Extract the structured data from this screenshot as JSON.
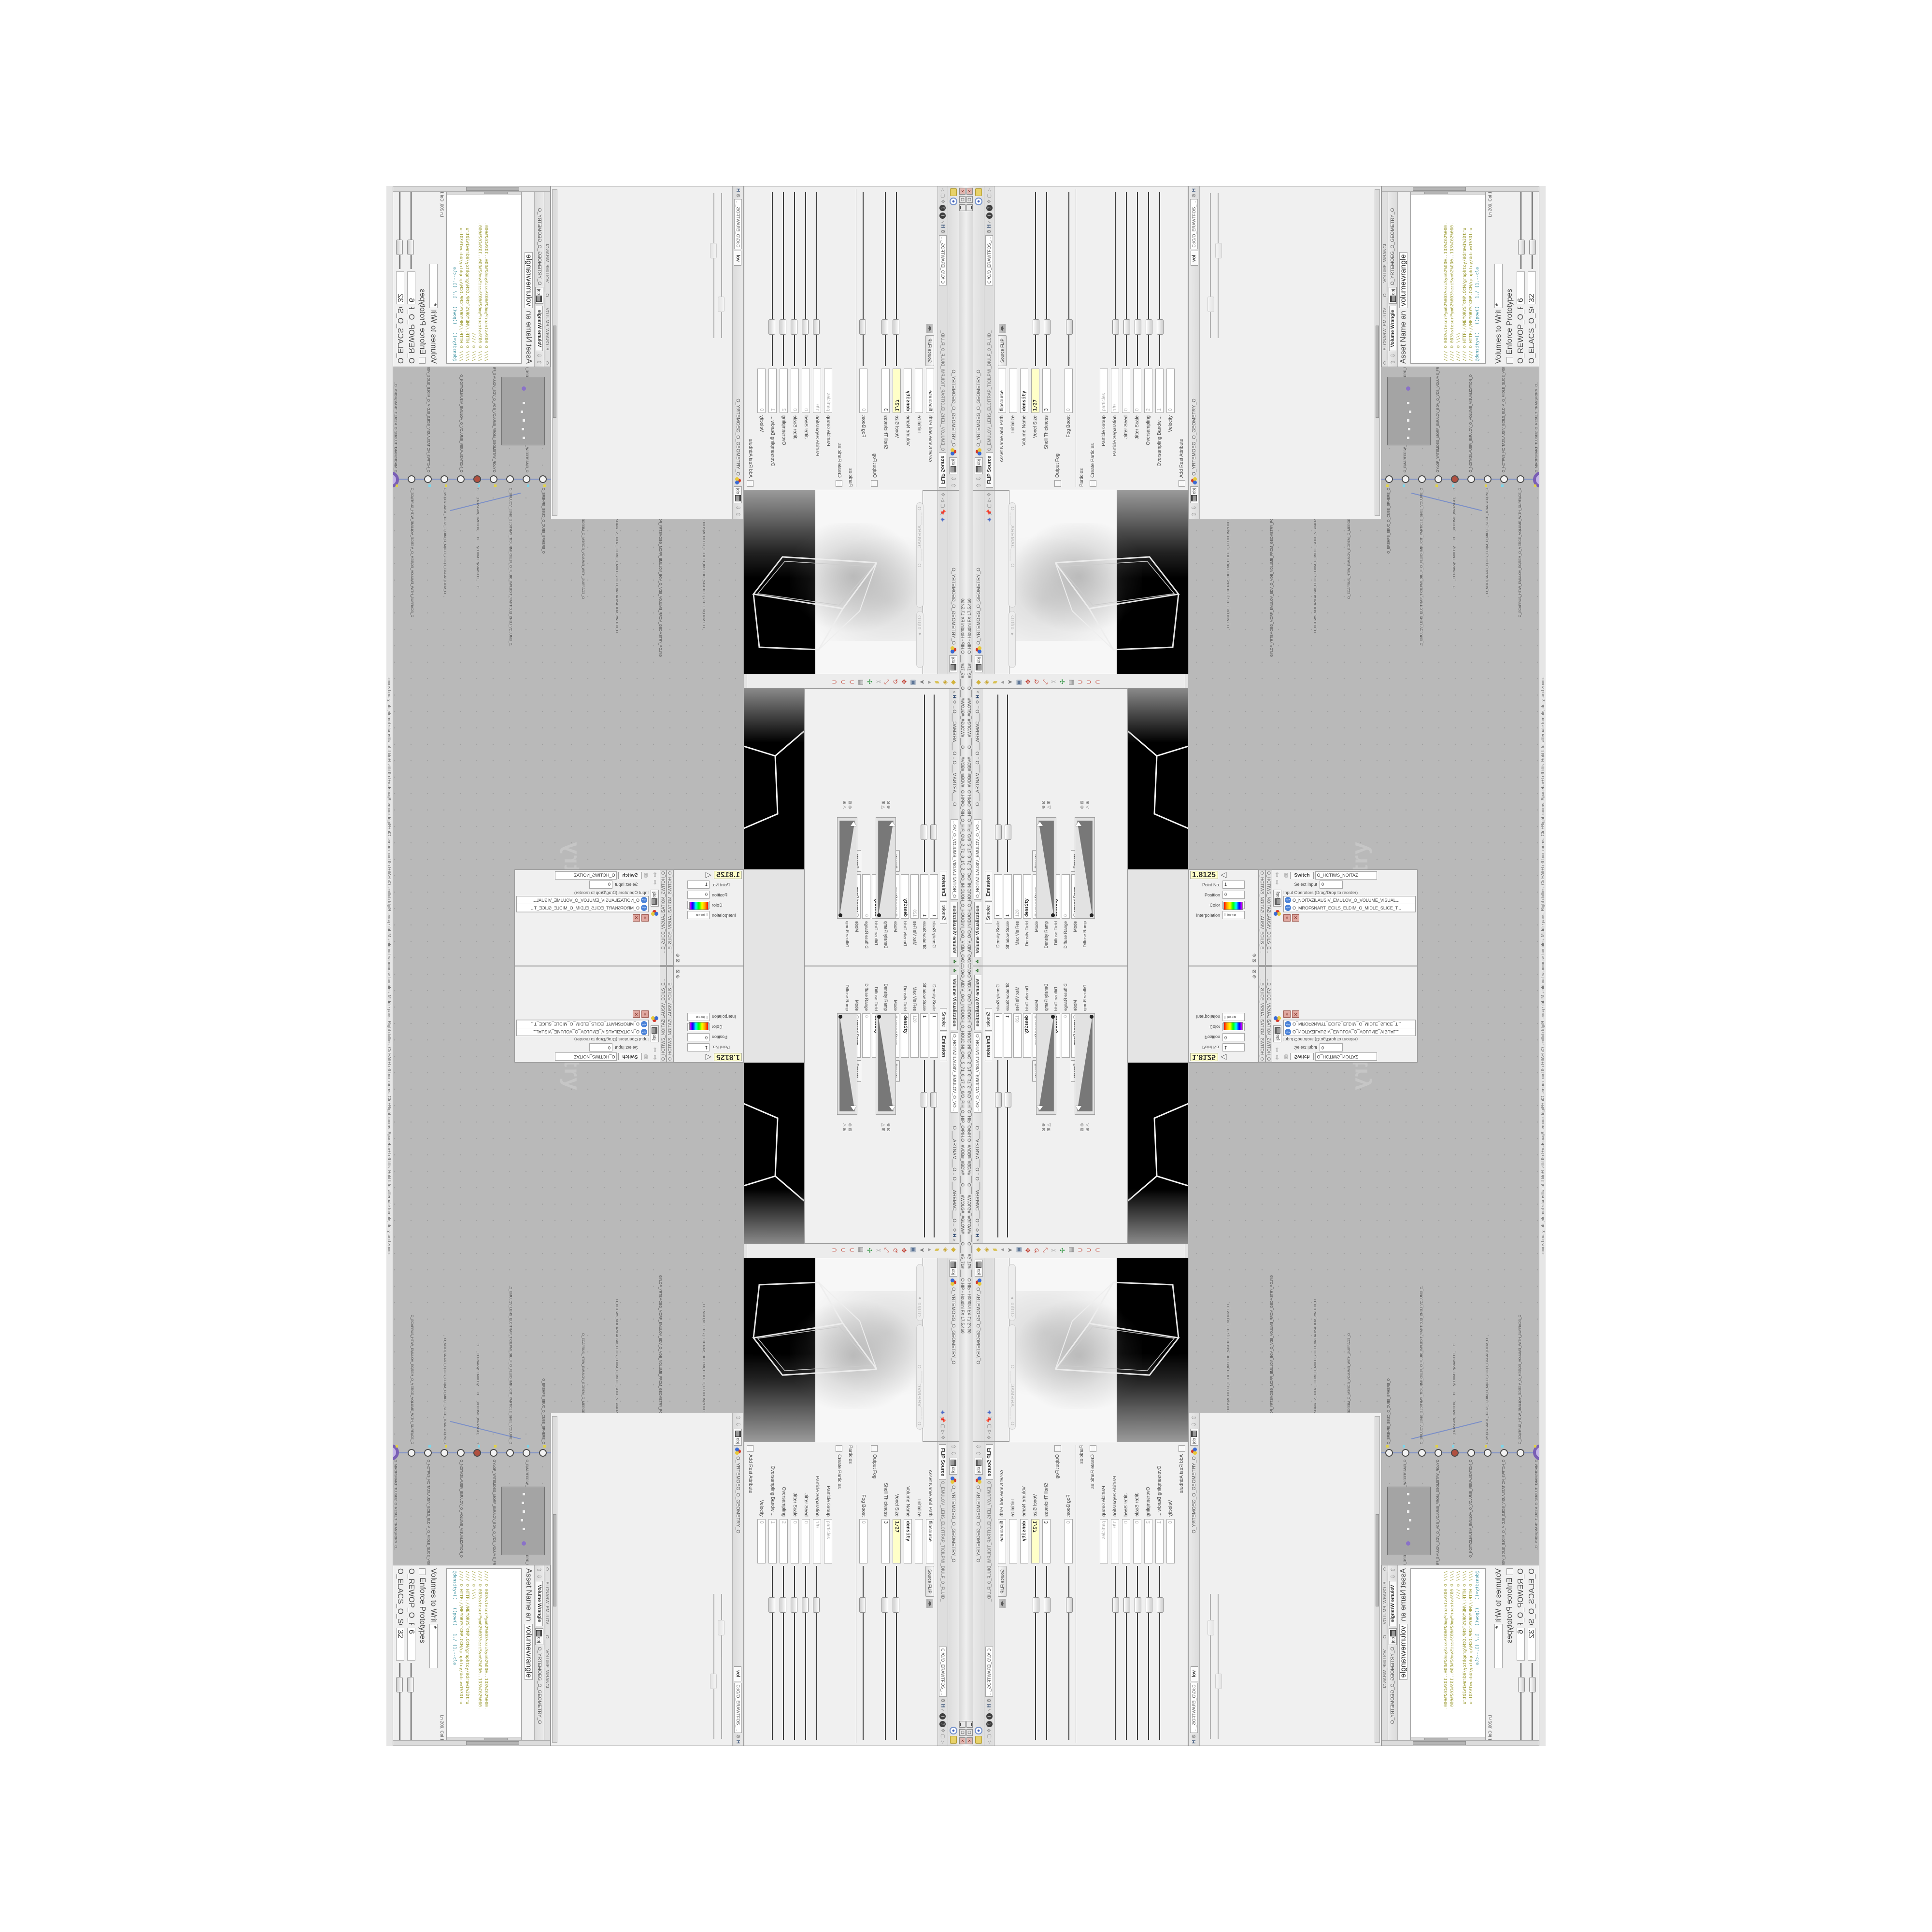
{
  "app": {
    "title_path": "C:/O/O_AIDIV_O/O_INIDUOH_O_HOUDINI_O/O_5_71_0_17_5_0/O_PIH_O_HIP_O/PIH.O",
    "title_right": "#VDB#_#BDV# ___O___ #WOLG#_#GLOW# ___O___ #5_71# ___ O.HIP - Houdini FX 17.5.460",
    "window_buttons": [
      "▁",
      "❐",
      "✕"
    ]
  },
  "status_bar": "mouse tumbles.  Middle pans.  Right dollies.  Ctrl+Alt+Left box zooms.  Ctrl+Right zooms.  Spacebar+Left tilts.  Hold L for alternate tumble, dolly, and zoom.",
  "breadcrumb": {
    "context": "obj",
    "path": "O_YRTEMOEG_O_GEOMETRY_O"
  },
  "flip_pane": {
    "window_title": "O_EMULOV_LEHS_ELCITRAP_TICILPMI_DIULF_O_FLUID_IMPLICIT_PARTICLE...",
    "tab": "FLIP Source",
    "path": "C:/O/O_ERAWTFOS_...",
    "asset_label": "Asset Name and Path",
    "asset_value": "flipsource",
    "asset_mode": "Source FLIP",
    "rows": [
      {
        "label": "Initialize",
        "value": "",
        "cls": ""
      },
      {
        "label": "Volume Name",
        "value": "density",
        "cls": "bold"
      },
      {
        "label": "Voxel Size",
        "value": "1/27",
        "cls": "key",
        "slider": true
      },
      {
        "label": "Shell Thickness",
        "value": "3",
        "cls": "",
        "slider": true
      },
      {
        "label": "Output Fog",
        "value": "",
        "cls": "check"
      },
      {
        "label": "Fog Boost",
        "value": "0",
        "cls": "dim",
        "slider": true
      },
      {
        "label": "Particles",
        "value": "",
        "cls": "group"
      },
      {
        "label": "Create Particles",
        "value": "",
        "cls": "check"
      },
      {
        "label": "Particle Group",
        "value": "particles",
        "cls": "dim"
      },
      {
        "label": "Particle Separation",
        "value": "1/9",
        "cls": "dim",
        "slider": true
      },
      {
        "label": "Jitter Seed",
        "value": "0",
        "cls": "dim",
        "slider": true
      },
      {
        "label": "Jitter Scale",
        "value": "0",
        "cls": "dim",
        "slider": true
      },
      {
        "label": "Oversampling",
        "value": "2",
        "cls": "dim",
        "slider": true
      },
      {
        "label": "Oversampling Bandwi...",
        "value": "1",
        "cls": "dim",
        "slider": true
      },
      {
        "label": "Velocity",
        "value": "0",
        "cls": "dim"
      },
      {
        "label": "Add Rest Attribute",
        "value": "",
        "cls": "check"
      },
      {
        "label": "Dual Rest Attributes",
        "value": "",
        "cls": "check"
      },
      {
        "label": "Rest Offset",
        "value": "0",
        "cls": "dim"
      }
    ]
  },
  "mid_pane": {
    "tab": "vol",
    "path": "C:/O/O_ERAWTFOS_..."
  },
  "wrangle_pane": {
    "window_title": "O ____ELGNARW_EMULOV____ O ____VOLUME_WRANGL...",
    "tab": "Volume Wrangle",
    "asset_label": "Asset Name and Path",
    "asset_value": "volumewrangle",
    "code": [
      {
        "text": "//// © 0D3%steserPym62%0D3%eziSym62%000..1D3%C62%000.",
        "cls": ""
      },
      {
        "text": "//// © 0D3%steserPym62%0D3%eziSym62%000..1D3%C62%000.",
        "cls": ""
      },
      {
        "text": "//// © \\\\\\\\",
        "cls": ""
      },
      {
        "text": "//// © HTTP://MEMORYST©MP.C©M/graphtoy/#draw1%3Dtru",
        "cls": ""
      },
      {
        "text": "//// © HTTP://MEMORYST©MP.C©M/graphtoy/#draw1%3Dtru",
        "cls": ""
      },
      {
        "text": "",
        "cls": ""
      },
      {
        "text": "@density=((   ((pow((   1./ (1.--cla",
        "cls": "teal"
      }
    ],
    "cursor": "Ln 209, Col 1",
    "volumes_label": "Volumes to Write to",
    "volumes_value": "*",
    "enforce_label": "Enforce Prototypes",
    "sliders": [
      {
        "label": "O_REWOP_O_POWER...",
        "value": "6",
        "cls": "",
        "slider": true
      },
      {
        "label": "O_ELACS_O_SCALE_O",
        "value": "32",
        "cls": "",
        "slider": true
      },
      {
        "label": "O_TFIHS_O_SHIFT_O",
        "value": "1.4375",
        "cls": "bold",
        "slider": true
      }
    ],
    "auto_update": "Auto Update"
  },
  "volviz_pane": {
    "window_title": "O_NOITAZILAUSIV_EMULOV_O_VO...",
    "tab": "Volume Visualization",
    "tabs_top": [
      "O ___ARTNAM___O...",
      "O ___AREMAC___O..."
    ],
    "smoke_tab": "Smoke",
    "emission_tab": "Emission",
    "rows": [
      {
        "label": "Density Scale",
        "value": "1",
        "cls": "",
        "slider": true
      },
      {
        "label": "Shadow Scale",
        "value": "1",
        "cls": "",
        "slider": true
      },
      {
        "label": "Max Vis Res",
        "value": "128",
        "cls": "dim"
      },
      {
        "label": "Density Field",
        "value": "density",
        "cls": "bold"
      },
      {
        "label": "Mode",
        "value": "Clamped Ramp",
        "cls": "hasbtn",
        "btn": "Presets"
      },
      {
        "label": "Density Ramp",
        "value": "",
        "cls": "ramp"
      },
      {
        "label": "Diffuse Field",
        "value": "density",
        "cls": "bold"
      },
      {
        "label": "Diffuse Range",
        "value": "0",
        "cls": "dim"
      },
      {
        "label": "Mode",
        "value": "Clamped Ramp",
        "cls": "hasbtn",
        "btn": "Presets"
      },
      {
        "label": "Diffuse Ramp",
        "value": "",
        "cls": "ramp"
      }
    ]
  },
  "ramp_fragment": {
    "value_field": "1.8125",
    "rows": [
      {
        "label": "Point No.",
        "value": "1",
        "cls": ""
      },
      {
        "label": "Position",
        "value": "0",
        "cls": ""
      },
      {
        "label": "Color",
        "value": "",
        "cls": ""
      },
      {
        "label": "Interpolation",
        "value": "Linear",
        "cls": ""
      }
    ]
  },
  "switch_pane": {
    "window_title": "O_HCTIWS_NOITAZILAUSIV_ECILS_E...",
    "tab": "Switch",
    "name_field": "O_HCTIWS_NOITAZ",
    "select_label": "Select Input",
    "select_value": "0",
    "list_label": "Input Operators (Drag/Drop to reorder)",
    "items": [
      {
        "name": "O_NOITAZILAUSIV_EMULOV_O_VOLUME_VISUAL..."
      },
      {
        "name": "O_MROFSNART_ECILS_ELDIM_O_MIDLE_SLICE_T..."
      }
    ]
  },
  "network": {
    "watermark": "Geometry",
    "nodes": [
      {
        "name": "O_EREHPS_EBUC_O_CUBE_SPHERE_O"
      },
      {
        "name": "O_EMARFERIW_NOGYLOP_EREHPS_EBUC_O_CUBE_SPHERE_POLYGON_WIREFRAME_O"
      },
      {
        "name": "O_EMULOV_LEHS_ELCITRAP_TICILPMI_DIULF_O_FLUID_IMPLICIT_PARTICLE_SHEL_VOLUME_O"
      },
      {
        "name": "GYLOP_YRTEMOEG_MORF_EMULOV_BDV_O_VDB_VOLUME_FROM_GEOMETRY_POLYGON_O"
      },
      {
        "name": "O ___ELGNARW_EMULOV___ O ___VOLUME_WRANGLE___ O"
      },
      {
        "name": "O_NOITAZILAUSIV_EMULOV_O_VOLUME_VISUALIZATION_O"
      },
      {
        "name": "O_MROFSNART_ECILS_ELDIM_O_MIDLE_SLICE_TRANSFORM_O"
      },
      {
        "name": "O_HCTIWS_NOITAZILAUSIV_ECILS_ELDIM_O_MIDLE_SLICE_VISUALIZATION_SWITCH_O"
      },
      {
        "name": "O_ECAFRUS_HTIW_EMULOV_EGREM_O_MERGE_VOLUME_WITH_SURFACE_O"
      },
      {
        "name": "O_MROFSNART_TLUSER_O_RESULT_TRANSFORM_O"
      }
    ]
  },
  "viewport": {
    "camera_pill": "O ____AREMAC____ O",
    "ortho_pill": "Ortho ▾",
    "label": "O_YRTEMOEG_O_GEOMETRY_O",
    "toolbar_icons": [
      {
        "glyph": "◆",
        "style": "color:#d2b23a"
      },
      {
        "glyph": "◈",
        "style": "color:#c8a52f"
      },
      {
        "glyph": "▰",
        "style": "color:#d8c050"
      },
      {
        "glyph": "◂",
        "style": "color:#9a9a9a"
      },
      {
        "glyph": "➤",
        "style": "color:#7a7a7a"
      },
      {
        "glyph": "▣",
        "style": "color:#5f7798"
      },
      {
        "glyph": "✥",
        "style": "color:#c0392b"
      },
      {
        "glyph": "↻",
        "style": "color:#c0392b"
      },
      {
        "glyph": "⤡",
        "style": "color:#c0392b"
      },
      {
        "glyph": "✂",
        "style": "color:#aaaaaa"
      },
      {
        "glyph": "✣",
        "style": "color:#3a9a4a"
      },
      {
        "glyph": "▥",
        "style": "color:#888888"
      },
      {
        "glyph": "⊃",
        "style": "color:#c0392b"
      },
      {
        "glyph": "⊃",
        "style": "color:#c0392b"
      },
      {
        "glyph": "⊂",
        "style": "color:#c0392b"
      }
    ],
    "side_icons": [
      {
        "glyph": "◉",
        "style": "color:#4a6ac8"
      },
      {
        "glyph": "📌",
        "style": "font-size:11px"
      },
      {
        "glyph": "▢",
        "style": "color:#777"
      },
      {
        "glyph": "▷",
        "style": "color:#777"
      },
      {
        "glyph": "✥",
        "style": "color:#888"
      }
    ]
  },
  "colors": {
    "code_olive": "#99992e",
    "code_teal": "#2e8a99",
    "key_yellow": "#ffffc8",
    "network_bg": "#b9b9b9",
    "wire_blue": "#7b8fc7",
    "node_purple": "#7a5fb5",
    "flag_yellow": "#e0d24a",
    "flag_cyan": "#7fd4e8"
  }
}
